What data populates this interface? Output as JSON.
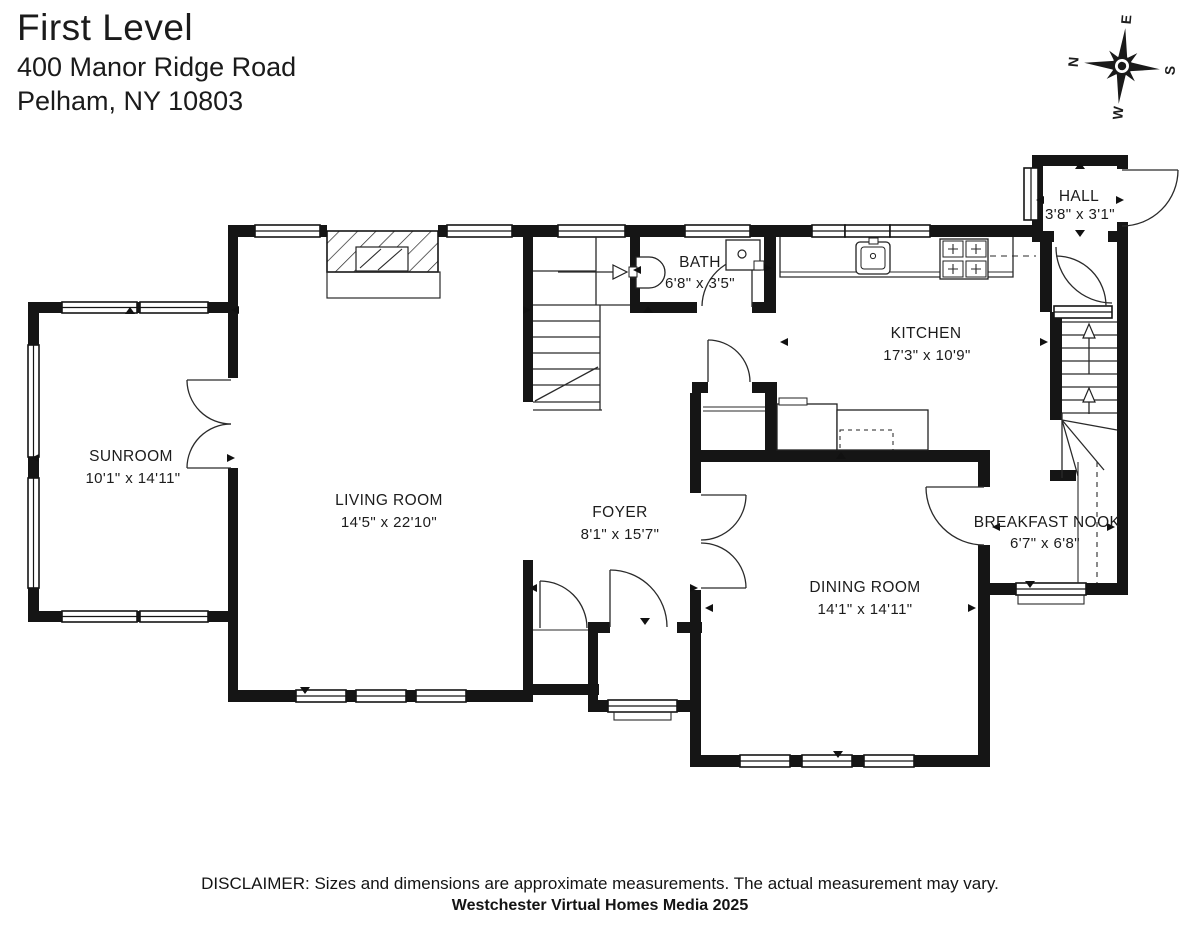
{
  "title": {
    "level": "First Level",
    "address_line1": "400 Manor Ridge Road",
    "address_line2": "Pelham, NY 10803"
  },
  "compass": {
    "n": "N",
    "e": "E",
    "s": "S",
    "w": "W"
  },
  "rooms": {
    "sunroom": {
      "name": "SUNROOM",
      "dims": "10'1\" x 14'11\""
    },
    "living": {
      "name": "LIVING ROOM",
      "dims": "14'5\" x 22'10\""
    },
    "foyer": {
      "name": "FOYER",
      "dims": "8'1\" x 15'7\""
    },
    "bath": {
      "name": "BATH",
      "dims": "6'8\" x 3'5\""
    },
    "kitchen": {
      "name": "KITCHEN",
      "dims": "17'3\" x 10'9\""
    },
    "hall": {
      "name": "HALL",
      "dims": "3'8\" x 3'1\""
    },
    "dining": {
      "name": "DINING ROOM",
      "dims": "14'1\" x 14'11\""
    },
    "nook": {
      "name": "BREAKFAST NOOK",
      "dims": "6'7\" x 6'8\""
    }
  },
  "footer": {
    "disclaimer": "DISCLAIMER: Sizes and dimensions are approximate measurements. The actual measurement may vary.",
    "credit": "Westchester Virtual Homes Media 2025"
  },
  "colors": {
    "wall": "#151515",
    "background": "#ffffff",
    "text": "#1c1c1c"
  }
}
